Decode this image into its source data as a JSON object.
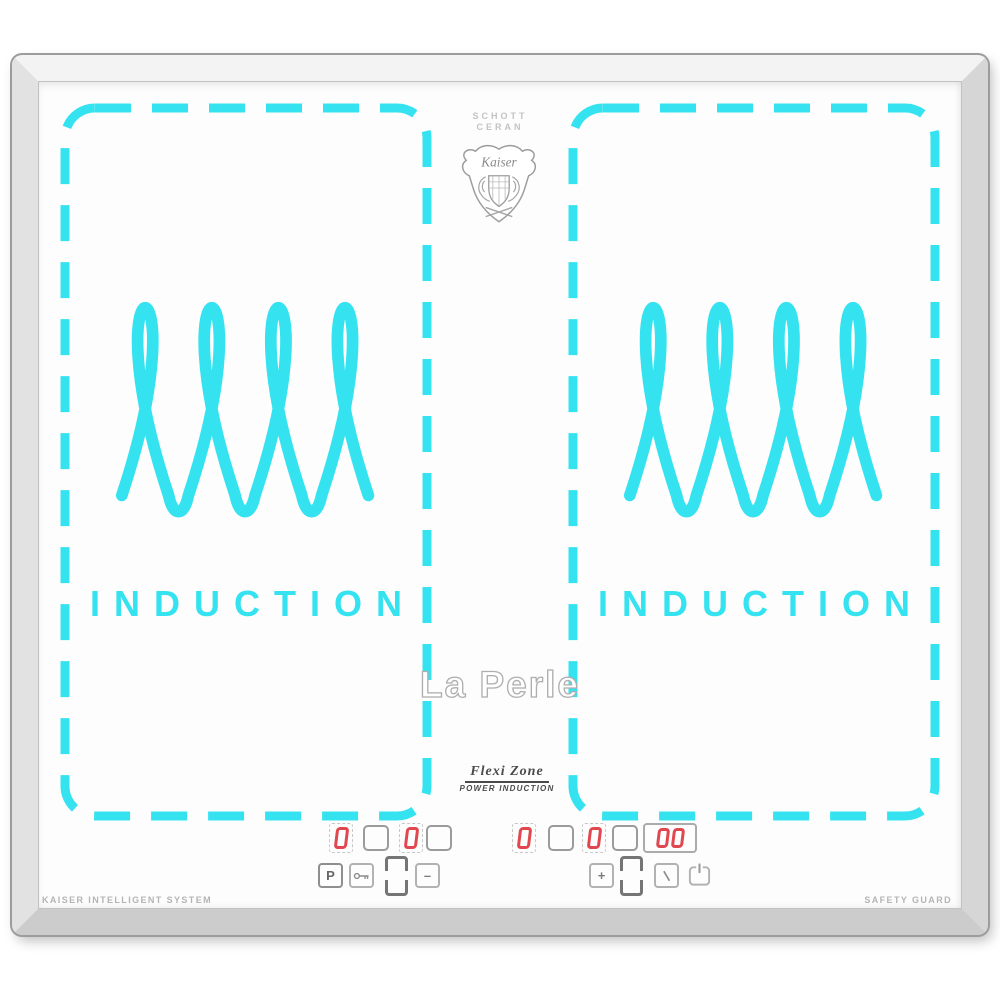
{
  "product": {
    "glass_brand_line1": "SCHOTT",
    "glass_brand_line2": "CERAN",
    "crest_brand": "Kaiser",
    "model_name": "La Perle",
    "feature_title": "Flexi Zone",
    "feature_subtitle": "POWER INDUCTION",
    "bottom_left_label": "KAISER INTELLIGENT SYSTEM",
    "bottom_right_label": "SAFETY GUARD"
  },
  "zones": [
    {
      "name": "left flexi zone",
      "induction_label": "INDUCTION"
    },
    {
      "name": "right flexi zone",
      "induction_label": "INDUCTION"
    }
  ],
  "controls": {
    "left": {
      "rear_power_display": "0",
      "front_power_display": "0",
      "boost_button_label": "P",
      "minus_button_label": "–",
      "icons": [
        "key-lock-icon",
        "zone-bridge-icon"
      ]
    },
    "right": {
      "rear_power_display": "0",
      "front_power_display": "0",
      "timer_display": "00",
      "plus_button_label": "+",
      "icons": [
        "zone-bridge-icon",
        "timer-clock-icon",
        "power-icon"
      ]
    }
  },
  "colors": {
    "accent_cyan": "#35E3F0",
    "display_red": "#E0474F",
    "frame_silver": "#E0E0E0",
    "glass_white": "#FDFDFD"
  }
}
